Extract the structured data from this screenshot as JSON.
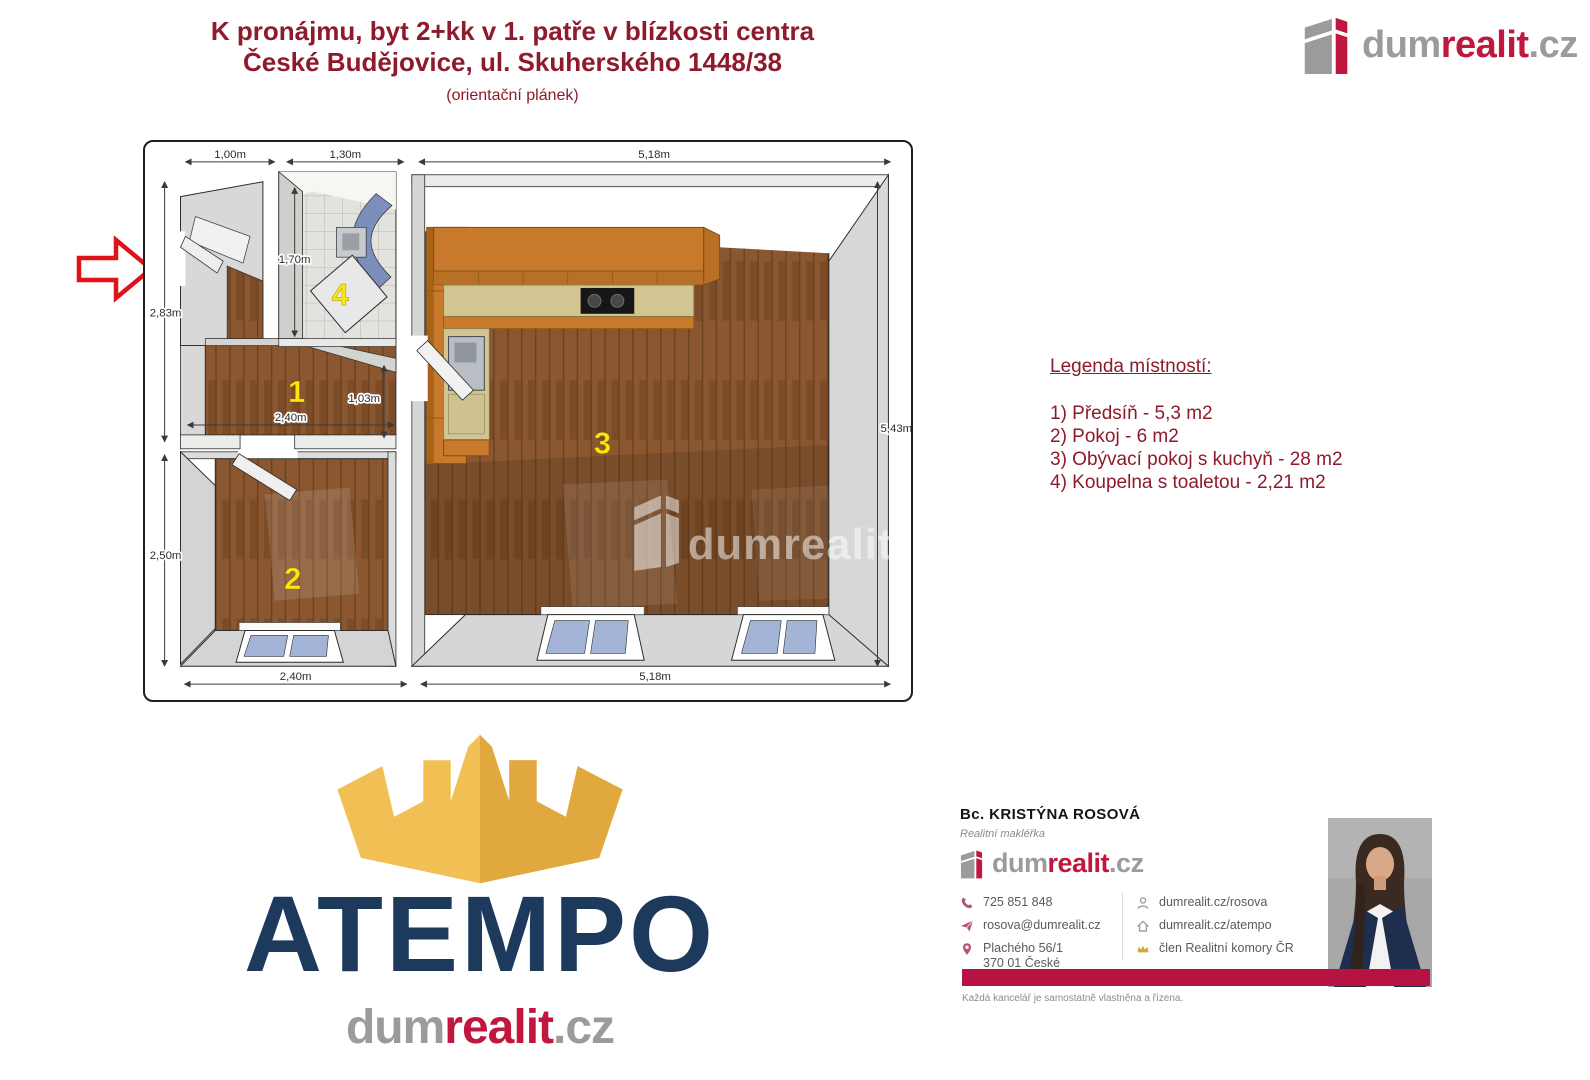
{
  "header": {
    "title_line1": "K pronájmu, byt 2+kk v 1. patře v blízkosti centra",
    "title_line2": "České Budějovice, ul. Skuherského 1448/38",
    "subtitle": "(orientační plánek)"
  },
  "brand": {
    "dum": "dum",
    "realit": "realit",
    "cz": ".cz"
  },
  "colors": {
    "brand_red": "#c0173f",
    "title_red": "#8e1a2c",
    "atempo_navy": "#1d3a5c",
    "crown_gold": "#f2bf55",
    "room_number_yellow": "#ffe60a",
    "footer_bar_red": "#b61244"
  },
  "legend": {
    "title": "Legenda místností:",
    "items": [
      "1) Předsíň - 5,3 m2",
      "2) Pokoj - 6 m2",
      "3) Obývací pokoj s kuchyň - 28 m2",
      "4) Koupelna s toaletou - 2,21 m2"
    ]
  },
  "floorplan": {
    "watermark": "dumrealit",
    "rooms": {
      "hall": "1",
      "bedroom": "2",
      "living": "3",
      "bathroom": "4"
    },
    "dims": {
      "top_entry": "1,00m",
      "top_bath": "1,30m",
      "top_living": "5,18m",
      "left_upper": "2,83m",
      "left_lower": "2,50m",
      "right_side": "5,43m",
      "bottom_bedroom": "2,40m",
      "bottom_living": "5,18m",
      "hall_width": "2,40m",
      "hall_depth": "1,03m",
      "bath_depth": "1,70m"
    }
  },
  "atempo": {
    "wordmark": "ATEMPO"
  },
  "agent": {
    "name": "Bc. KRISTÝNA ROSOVÁ",
    "role": "Realitní makléřka",
    "phone": "725 851 848",
    "email": "rosova@dumrealit.cz",
    "address_line1": "Plachého 56/1",
    "address_line2": "370 01 České Budějovice",
    "web_profile": "dumrealit.cz/rosova",
    "web_office": "dumrealit.cz/atempo",
    "membership": "člen Realitní komory ČR"
  },
  "footer": {
    "disclaimer": "Každá kancelář je samostatně vlastněna a řízena."
  }
}
